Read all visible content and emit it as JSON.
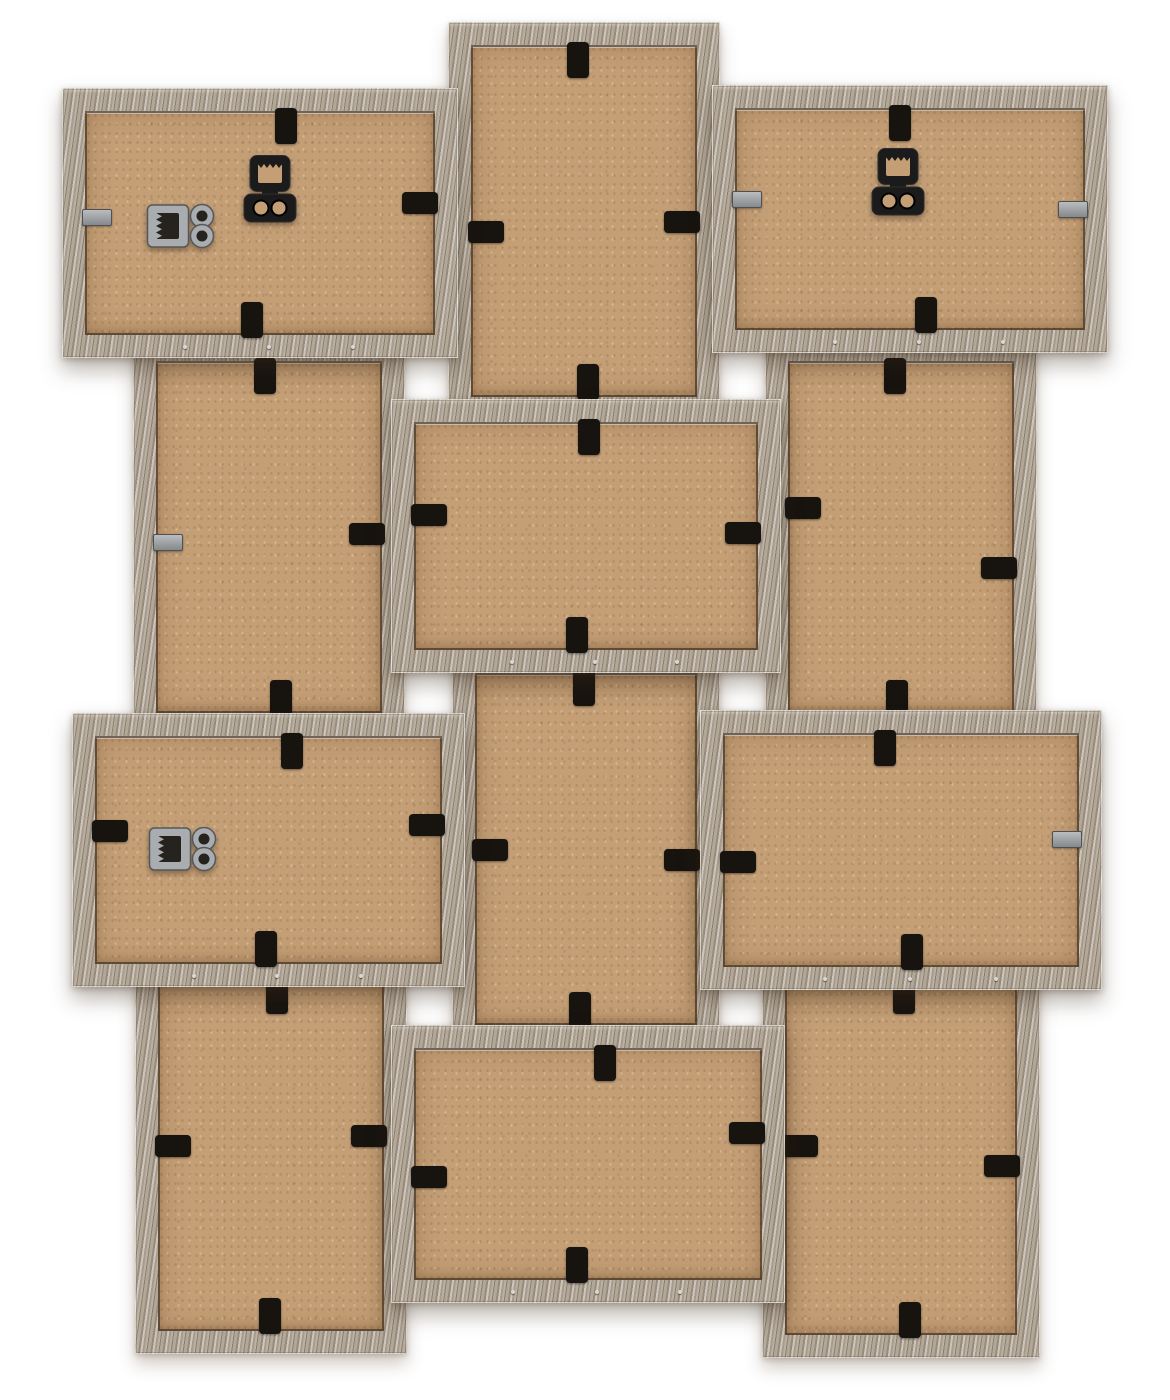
{
  "image": {
    "description": "Rear view of a twelve-opening wooden collage photo frame: a checkerboard of six landscape and six portrait frames in weathered grey-brown wood, each with a tan MDF backing board held by small black retainer clips and silver glazing tabs, with sawtooth hanging hardware on three of the frames, photographed on a white background.",
    "background_color": "#ffffff"
  },
  "style": {
    "wood_light": "#cdc5ba",
    "wood_mid": "#a79b8d",
    "wood_dark": "#8a7f71",
    "backing_tan": "#c49f76",
    "clip_black": "#17130f",
    "metal_silver": "#a9adb0",
    "seam_dark": "rgba(40,30,20,0.55)",
    "border_px": 23
  },
  "frames": [
    {
      "id": "top-left",
      "orientation": "landscape",
      "x": 62,
      "y": 88,
      "w": 396,
      "h": 270,
      "z": 3,
      "hardware": [
        {
          "type": "sawtooth-ring-hanger",
          "finish": "silver",
          "x": 84,
          "y": 112,
          "w": 74,
          "h": 52
        },
        {
          "type": "sawtooth-keyhole-hanger",
          "finish": "black",
          "x": 180,
          "y": 66,
          "w": 56,
          "h": 70
        }
      ],
      "clips": [
        {
          "edge": "top",
          "at": 224,
          "style": "black"
        },
        {
          "edge": "bottom",
          "at": 190,
          "style": "black"
        },
        {
          "edge": "right",
          "at": 115,
          "style": "black"
        },
        {
          "edge": "left",
          "at": 135,
          "style": "silver"
        }
      ]
    },
    {
      "id": "top-center",
      "orientation": "portrait",
      "x": 448,
      "y": 22,
      "w": 272,
      "h": 398,
      "z": 1,
      "hardware": [],
      "clips": [
        {
          "edge": "top",
          "at": 130,
          "style": "black"
        },
        {
          "edge": "left",
          "at": 210,
          "style": "black"
        },
        {
          "edge": "right",
          "at": 200,
          "style": "black"
        },
        {
          "edge": "bottom",
          "at": 140,
          "style": "black"
        }
      ]
    },
    {
      "id": "top-right",
      "orientation": "landscape",
      "x": 712,
      "y": 85,
      "w": 396,
      "h": 268,
      "z": 3,
      "hardware": [
        {
          "type": "sawtooth-keyhole-hanger",
          "finish": "black",
          "x": 158,
          "y": 62,
          "w": 56,
          "h": 70
        }
      ],
      "clips": [
        {
          "edge": "top",
          "at": 188,
          "style": "black"
        },
        {
          "edge": "bottom",
          "at": 214,
          "style": "black"
        },
        {
          "edge": "left",
          "at": 120,
          "style": "silver"
        },
        {
          "edge": "right",
          "at": 130,
          "style": "silver"
        }
      ]
    },
    {
      "id": "middle-left",
      "orientation": "portrait",
      "x": 133,
      "y": 338,
      "w": 272,
      "h": 398,
      "z": 1,
      "hardware": [],
      "clips": [
        {
          "edge": "top",
          "at": 132,
          "style": "black"
        },
        {
          "edge": "left",
          "at": 210,
          "style": "silver"
        },
        {
          "edge": "right",
          "at": 196,
          "style": "black"
        },
        {
          "edge": "bottom",
          "at": 148,
          "style": "black"
        }
      ]
    },
    {
      "id": "center",
      "orientation": "landscape",
      "x": 391,
      "y": 399,
      "w": 390,
      "h": 274,
      "z": 3,
      "hardware": [],
      "clips": [
        {
          "edge": "top",
          "at": 198,
          "style": "black"
        },
        {
          "edge": "bottom",
          "at": 186,
          "style": "black"
        },
        {
          "edge": "left",
          "at": 116,
          "style": "black"
        },
        {
          "edge": "right",
          "at": 134,
          "style": "black"
        }
      ]
    },
    {
      "id": "middle-right",
      "orientation": "portrait",
      "x": 765,
      "y": 338,
      "w": 272,
      "h": 398,
      "z": 1,
      "hardware": [],
      "clips": [
        {
          "edge": "top",
          "at": 130,
          "style": "black"
        },
        {
          "edge": "left",
          "at": 170,
          "style": "black"
        },
        {
          "edge": "right",
          "at": 230,
          "style": "black"
        },
        {
          "edge": "bottom",
          "at": 132,
          "style": "black"
        }
      ]
    },
    {
      "id": "lower-left",
      "orientation": "landscape",
      "x": 72,
      "y": 713,
      "w": 393,
      "h": 274,
      "z": 3,
      "hardware": [
        {
          "type": "sawtooth-ring-hanger",
          "finish": "silver",
          "x": 76,
          "y": 110,
          "w": 74,
          "h": 52
        }
      ],
      "clips": [
        {
          "edge": "top",
          "at": 220,
          "style": "black"
        },
        {
          "edge": "bottom",
          "at": 194,
          "style": "black"
        },
        {
          "edge": "left",
          "at": 118,
          "style": "black"
        },
        {
          "edge": "right",
          "at": 112,
          "style": "black"
        }
      ]
    },
    {
      "id": "lower-center",
      "orientation": "portrait",
      "x": 452,
      "y": 650,
      "w": 268,
      "h": 398,
      "z": 1,
      "hardware": [],
      "clips": [
        {
          "edge": "top",
          "at": 132,
          "style": "black"
        },
        {
          "edge": "left",
          "at": 200,
          "style": "black"
        },
        {
          "edge": "right",
          "at": 210,
          "style": "black"
        },
        {
          "edge": "bottom",
          "at": 128,
          "style": "black"
        }
      ]
    },
    {
      "id": "lower-right",
      "orientation": "landscape",
      "x": 700,
      "y": 710,
      "w": 402,
      "h": 280,
      "z": 3,
      "hardware": [],
      "clips": [
        {
          "edge": "top",
          "at": 185,
          "style": "black"
        },
        {
          "edge": "bottom",
          "at": 212,
          "style": "black"
        },
        {
          "edge": "left",
          "at": 152,
          "style": "black"
        },
        {
          "edge": "right",
          "at": 135,
          "style": "silver"
        }
      ]
    },
    {
      "id": "bottom-center",
      "orientation": "landscape",
      "x": 391,
      "y": 1025,
      "w": 394,
      "h": 278,
      "z": 3,
      "hardware": [],
      "clips": [
        {
          "edge": "top",
          "at": 214,
          "style": "black"
        },
        {
          "edge": "bottom",
          "at": 186,
          "style": "black"
        },
        {
          "edge": "left",
          "at": 152,
          "style": "black"
        },
        {
          "edge": "right",
          "at": 108,
          "style": "black"
        }
      ]
    },
    {
      "id": "bottom-left",
      "orientation": "portrait",
      "x": 135,
      "y": 958,
      "w": 272,
      "h": 396,
      "z": 1,
      "hardware": [],
      "clips": [
        {
          "edge": "top",
          "at": 142,
          "style": "black"
        },
        {
          "edge": "left",
          "at": 188,
          "style": "black"
        },
        {
          "edge": "right",
          "at": 178,
          "style": "black"
        },
        {
          "edge": "bottom",
          "at": 135,
          "style": "black"
        }
      ]
    },
    {
      "id": "bottom-right",
      "orientation": "portrait",
      "x": 762,
      "y": 958,
      "w": 278,
      "h": 400,
      "z": 1,
      "hardware": [],
      "clips": [
        {
          "edge": "top",
          "at": 142,
          "style": "black"
        },
        {
          "edge": "left",
          "at": 188,
          "style": "black"
        },
        {
          "edge": "right",
          "at": 208,
          "style": "black"
        },
        {
          "edge": "bottom",
          "at": 148,
          "style": "black"
        }
      ]
    }
  ]
}
